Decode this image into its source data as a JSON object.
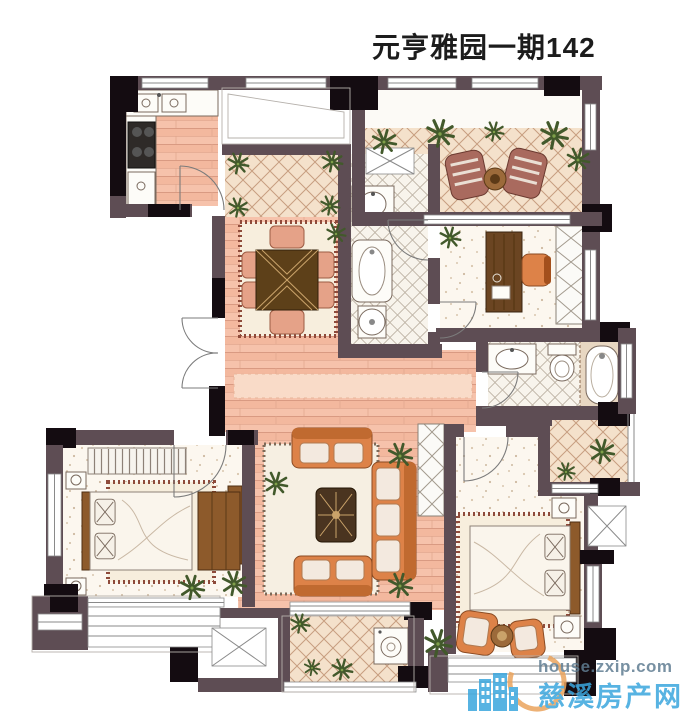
{
  "title": "元亨雅园一期142",
  "watermark": {
    "site": "house.zxip.com",
    "name": "慈溪房产网"
  },
  "colors": {
    "wall": "#5e4d54",
    "column": "#140c11",
    "plank_floor": "#f6c2ab",
    "plank_line": "#d99a82",
    "tile_floor": "#f4e1cb",
    "tile_line": "#c79e80",
    "bath_tile": "#f8f4ec",
    "bath_tile_line": "#b9ae9f",
    "bedroom_floor": "#fcf7ef",
    "rug": "#f7eedd",
    "rug_border": "#8e4a3a",
    "sofa": "#dd8248",
    "wood": "#8d5a2b",
    "plant": "#42592b",
    "watermark_blue": "#3aa6de",
    "watermark_gray": "#607d92",
    "watermark_orange": "#eba45e"
  }
}
